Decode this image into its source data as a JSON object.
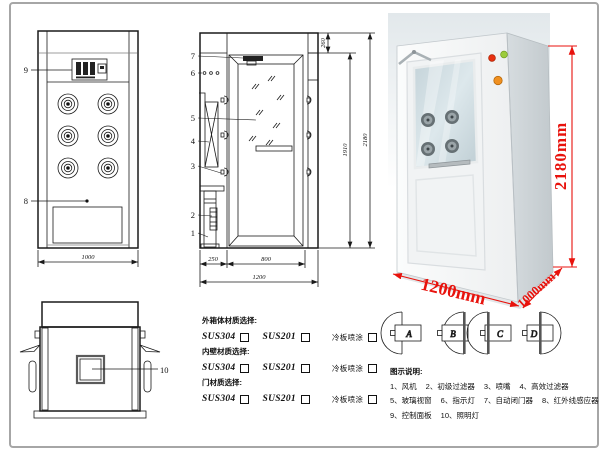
{
  "colors": {
    "dimension_red": "#e8120c",
    "drawing_line": "#1a1a1a",
    "frame_border": "#a6a6a6",
    "cabinet_front": "#f6f8f8",
    "cabinet_side": "#ccd3d7",
    "glass": "#c9d7dc",
    "indicator_red": "#e83010",
    "indicator_green": "#9ccc3c",
    "emergency_orange": "#f09020"
  },
  "front_view": {
    "callout_9": "9",
    "callout_8": "8",
    "dim_width": "1000"
  },
  "side_view": {
    "callout_7": "7",
    "callout_6": "6",
    "callout_5": "5",
    "callout_4": "4",
    "callout_3": "3",
    "callout_2": "2",
    "callout_1": "1",
    "dim_top": "260",
    "dim_door_height": "1910",
    "dim_total_height": "2180",
    "dim_left_section": "250",
    "dim_door_width": "800",
    "dim_total_width": "1200"
  },
  "photo": {
    "dim_height": "2180mm",
    "dim_width": "1200mm",
    "dim_depth": "1000mm"
  },
  "top_view": {
    "callout_10": "10"
  },
  "materials": {
    "sections": [
      {
        "label": "外箱体材质选择:",
        "options": [
          "SUS304",
          "SUS201",
          "冷板喷涂"
        ]
      },
      {
        "label": "内壁材质选择:",
        "options": [
          "SUS304",
          "SUS201",
          "冷板喷涂"
        ]
      },
      {
        "label": "门材质选择:",
        "options": [
          "SUS304",
          "SUS201",
          "冷板喷涂"
        ]
      }
    ]
  },
  "door_options": {
    "a": "A",
    "b": "B",
    "c": "C",
    "d": "D"
  },
  "legend": {
    "title": "图示说明:",
    "rows": [
      [
        "1、风机",
        "2、初级过滤器",
        "3、喷嘴",
        "4、高效过滤器"
      ],
      [
        "5、玻璃视窗",
        "6、指示灯",
        "7、自动闭门器",
        "8、红外线感应器"
      ],
      [
        "9、控制面板",
        "10、照明灯"
      ]
    ]
  }
}
